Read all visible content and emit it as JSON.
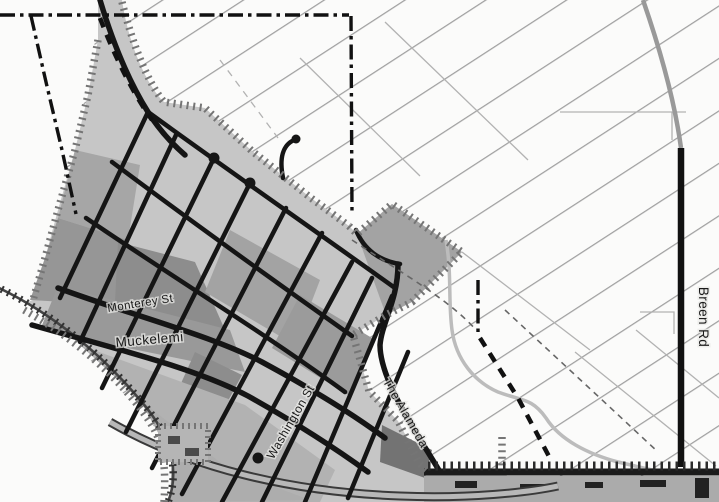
{
  "map": {
    "street_labels": [
      {
        "id": "monterey",
        "text": "Monterey St"
      },
      {
        "id": "muckelemi",
        "text": "Muckelemi"
      },
      {
        "id": "washington",
        "text": "Washington St"
      },
      {
        "id": "alameda",
        "text": "The Alameda"
      },
      {
        "id": "breen",
        "text": "Breen Rd"
      }
    ],
    "colors": {
      "background": "#fbfbfa",
      "rural_hatch_line": "#a0a0a0",
      "city_fill": "#c6c6c6",
      "district_medium": "#a4a4a4",
      "district_dark": "#8b8b8b",
      "district_darkest": "#737373",
      "street": "#151515",
      "boundary_dashdot": "#111111",
      "tick_boundary": "#757575",
      "creek": "#bcbcbc",
      "road_casing": "#3a3a3a",
      "road_fill": "#b8b8b8"
    }
  }
}
